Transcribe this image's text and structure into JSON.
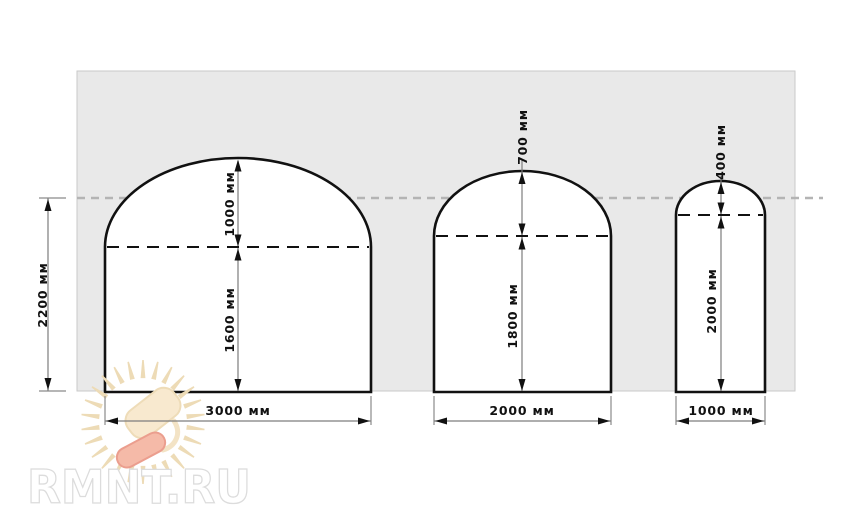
{
  "page": {
    "background": "#ffffff"
  },
  "watermark": {
    "site_text": "RMNT.RU",
    "colors": {
      "text_fill": "#ffffff",
      "text_outline": "#dcdcdc",
      "rays": "#eddbb6",
      "pad_fill": "#f8e9cf",
      "pad_outline": "#eedcb8",
      "roller_fill": "#f5baa8",
      "roller_outline": "#eb9e8e"
    }
  },
  "diagram": {
    "type": "dimensioned-arch-drawing",
    "unit": "мм",
    "overall_height": {
      "label": "2200 мм",
      "value": 2200
    },
    "arches": [
      {
        "name": "large-arch",
        "width": {
          "label": "3000 мм",
          "value": 3000
        },
        "wall_height": {
          "label": "1600 мм",
          "value": 1600
        },
        "arch_rise": {
          "label": "1000 мм",
          "value": 1000
        }
      },
      {
        "name": "medium-arch",
        "width": {
          "label": "2000 мм",
          "value": 2000
        },
        "wall_height": {
          "label": "1800 мм",
          "value": 1800
        },
        "arch_rise": {
          "label": "700 мм",
          "value": 700
        }
      },
      {
        "name": "small-arch",
        "width": {
          "label": "1000 мм",
          "value": 1000
        },
        "wall_height": {
          "label": "2000 мм",
          "value": 2000
        },
        "arch_rise": {
          "label": "400 мм",
          "value": 400
        }
      }
    ],
    "colors": {
      "panel_fill": "#e9e9e9",
      "panel_border": "#c9c9c9",
      "outline": "#111111",
      "dimension_line": "#7d7d7d",
      "reference_dashed_line": "#b4b4b4",
      "label_text": "#111111"
    }
  }
}
